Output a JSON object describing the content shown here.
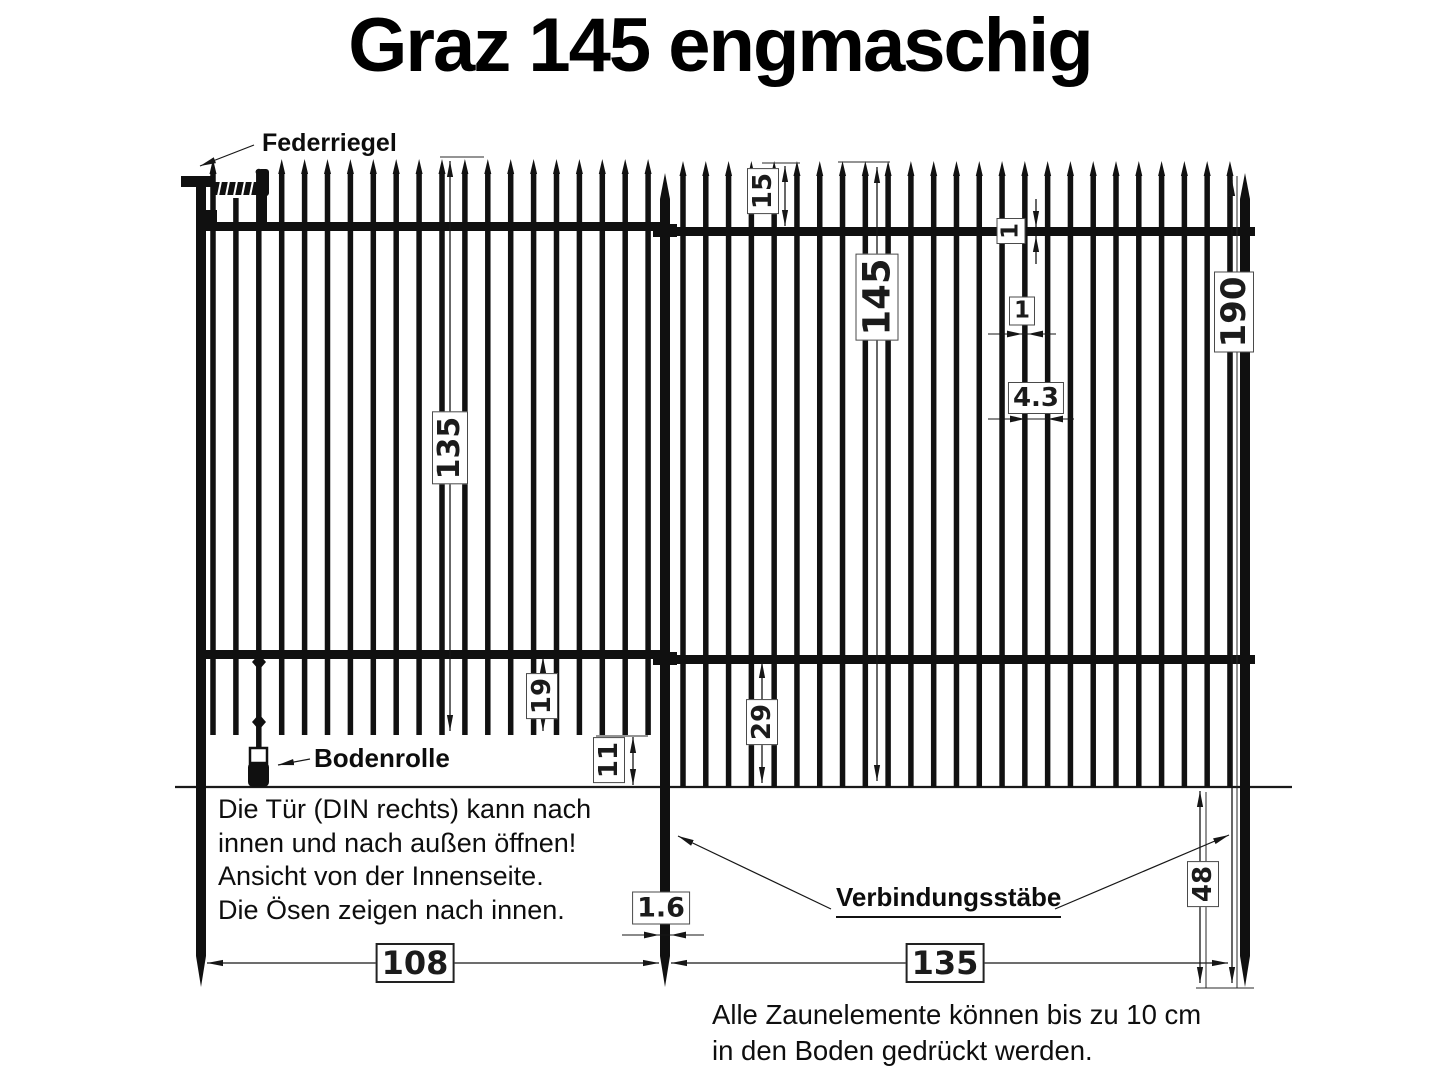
{
  "title": "Graz 145 engmaschig",
  "labels": {
    "federriegel": "Federriegel",
    "bodenrolle": "Bodenrolle",
    "verbindungsstaebe": "Verbindungsstäbe"
  },
  "dimensions": {
    "tip_to_rail_cm": "15",
    "element_height_cm": "145",
    "rail_thickness_cm": "1",
    "bar_width_cm": "1",
    "bar_spacing_cm": "4.3",
    "post_length_cm": "190",
    "gate_bar_length_cm": "135",
    "gate_bar_overhang_cm": "19",
    "gate_ground_clearance_cm": "11",
    "panel_bar_overhang_cm": "29",
    "post_width_cm": "1.6",
    "gate_width_cm": "108",
    "panel_width_cm": "135",
    "post_below_ground_cm": "48"
  },
  "notes": {
    "door": [
      "Die Tür (DIN rechts) kann nach",
      "innen und nach außen öffnen!",
      "Ansicht von der Innenseite.",
      "Die Ösen zeigen nach innen."
    ],
    "ground": [
      "Alle Zaunelemente können bis zu 10 cm",
      "in den Boden gedrückt werden."
    ]
  },
  "colors": {
    "ink": "#111111",
    "background": "#ffffff"
  }
}
